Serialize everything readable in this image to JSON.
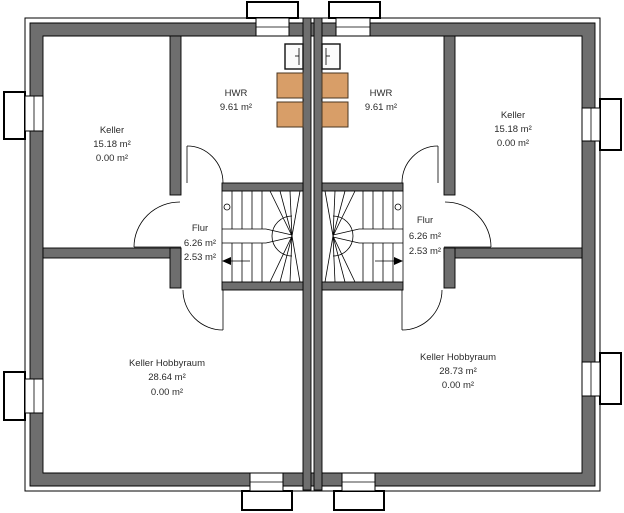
{
  "plan": {
    "type": "floor-plan",
    "colors": {
      "wall_fill": "#6e6e6e",
      "appliance_fill": "#d89e68",
      "background": "#ffffff",
      "line": "#000000",
      "text": "#2b2b2b"
    },
    "rooms": {
      "keller_left": {
        "name": "Keller",
        "area1": "15.18 m²",
        "area2": "0.00 m²"
      },
      "hwr_left": {
        "name": "HWR",
        "area1": "9.61 m²"
      },
      "hwr_right": {
        "name": "HWR",
        "area1": "9.61 m²"
      },
      "keller_right": {
        "name": "Keller",
        "area1": "15.18 m²",
        "area2": "0.00 m²"
      },
      "flur_left": {
        "name": "Flur",
        "area1": "6.26 m²",
        "area2": "2.53 m²"
      },
      "flur_right": {
        "name": "Flur",
        "area1": "6.26 m²",
        "area2": "2.53 m²"
      },
      "hobbyraum_left": {
        "name": "Keller Hobbyraum",
        "area1": "28.64 m²",
        "area2": "0.00 m²"
      },
      "hobbyraum_right": {
        "name": "Keller Hobbyraum",
        "area1": "28.73 m²",
        "area2": "0.00 m²"
      }
    }
  }
}
